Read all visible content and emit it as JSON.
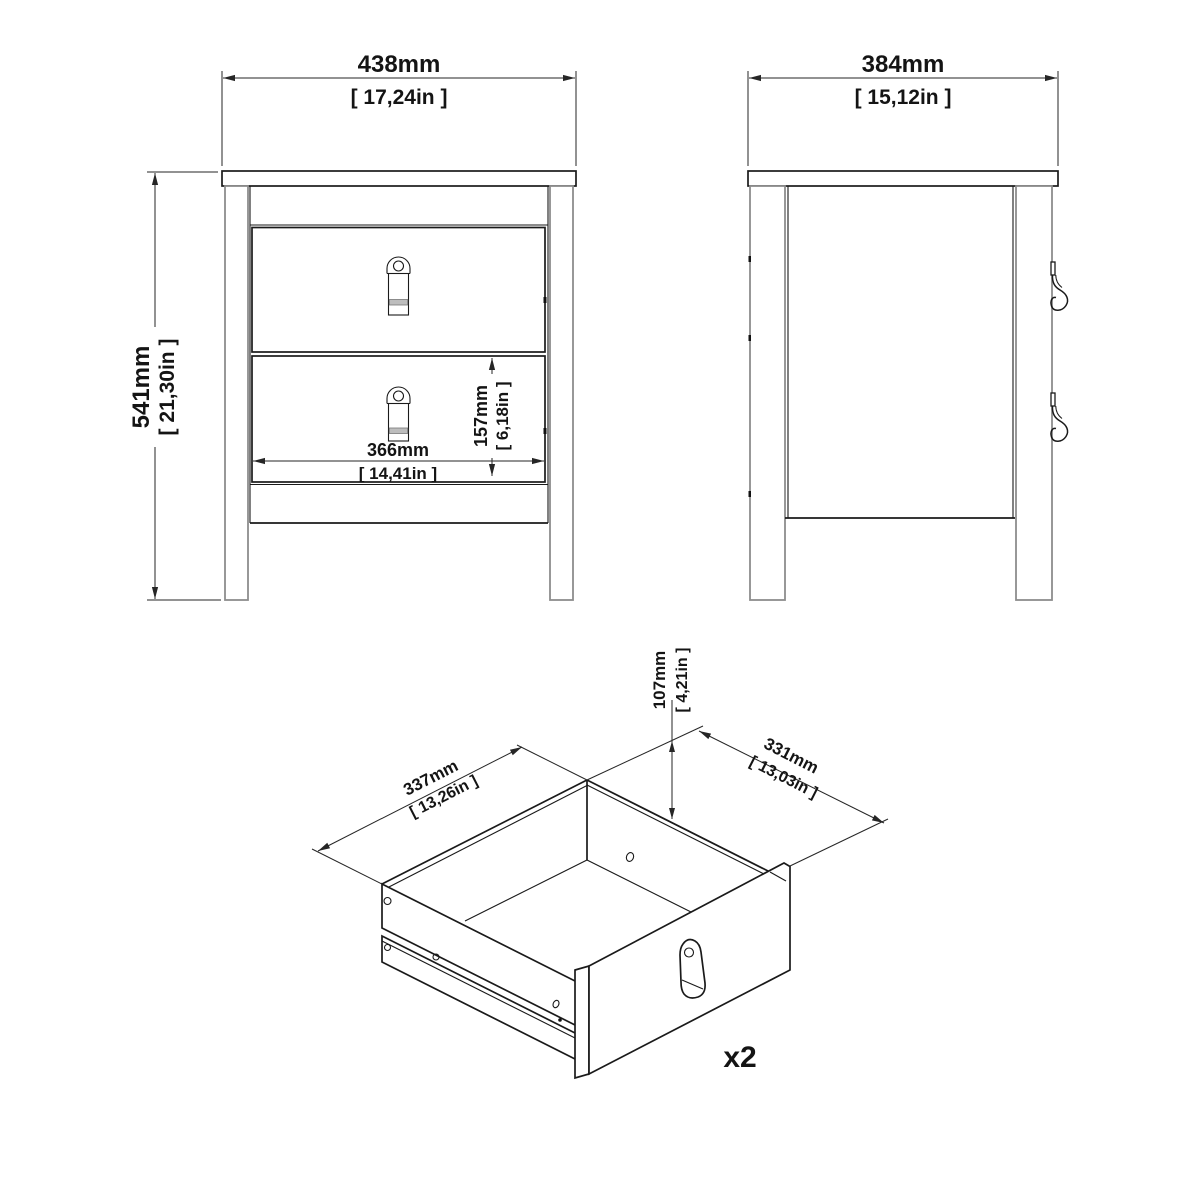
{
  "front_view": {
    "width_mm": "438mm",
    "width_in": "[ 17,24in ]",
    "height_mm": "541mm",
    "height_in": "[ 21,30in ]",
    "inner_width_mm": "366mm",
    "inner_width_in": "[ 14,41in ]",
    "drawer_front_mm": "157mm",
    "drawer_front_in": "[ 6,18in ]"
  },
  "side_view": {
    "depth_mm": "384mm",
    "depth_in": "[ 15,12in ]"
  },
  "drawer_view": {
    "side_mm": "337mm",
    "side_in": "[ 13,26in ]",
    "front_mm": "331mm",
    "front_in": "[ 13,03in ]",
    "height_mm": "107mm",
    "height_in": "[ 4,21in ]",
    "quantity_label": "x2"
  },
  "colors": {
    "line": "#1a1a1a",
    "dimension": "#262626",
    "leg_grey": "#8d8d8d",
    "handle_band": "#bdbdbd",
    "background": "#ffffff"
  }
}
